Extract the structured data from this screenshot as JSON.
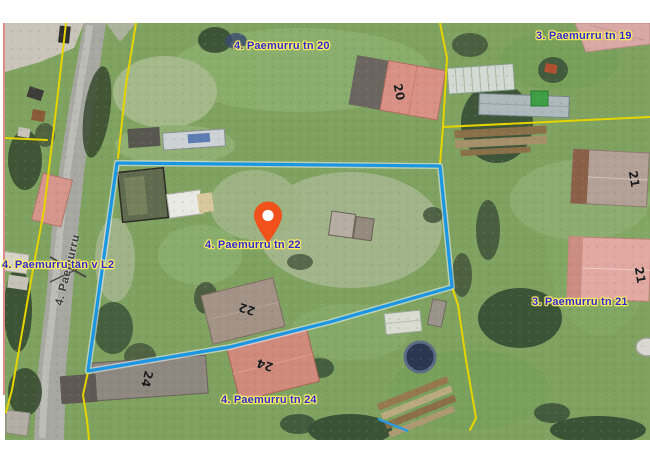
{
  "map": {
    "type": "aerial-cadastral-view",
    "selected_parcel": "4. Paemurru tn 22",
    "labels": [
      {
        "text": "4. Paemurru tn 20"
      },
      {
        "text": "3. Paemurru tn 19"
      },
      {
        "text": "4. Paemurru tän v L2"
      },
      {
        "text": "4. Paemurru tn 22"
      },
      {
        "text": "3. Paemurru tn 21"
      },
      {
        "text": "4. Paemurru tn 24"
      }
    ],
    "road_label": "4. Paemurru",
    "house_numbers": [
      "20",
      "21",
      "21",
      "22",
      "24",
      "24"
    ],
    "colors": {
      "parcel_highlight": "#1b96e3",
      "cadastral_line": "#e6d400",
      "address_text": "#2b2bd0",
      "address_halo": "#ffee66",
      "pin": "#f1511b"
    }
  }
}
